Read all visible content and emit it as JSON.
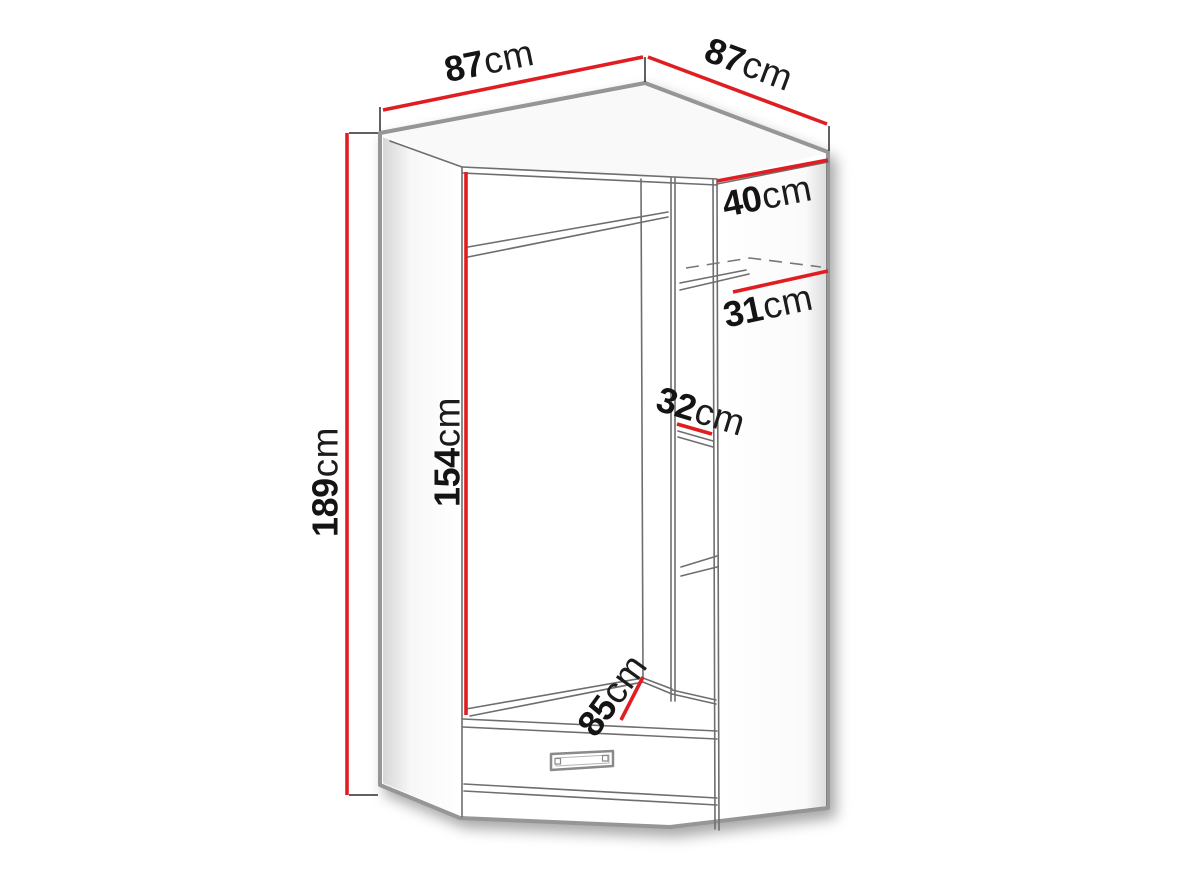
{
  "diagram": {
    "type": "furniture-dimension-diagram",
    "subject": "corner-wardrobe",
    "unit": "cm",
    "colors": {
      "dimension_line": "#e01e22",
      "outline": "#969696",
      "inner_line": "#6e6e6e",
      "label_text": "#141414",
      "background": "#ffffff"
    },
    "dimensions": [
      {
        "id": "top-width-left",
        "value": "87",
        "unit": "cm"
      },
      {
        "id": "top-width-right",
        "value": "87",
        "unit": "cm"
      },
      {
        "id": "side-depth",
        "value": "40",
        "unit": "cm"
      },
      {
        "id": "shelf-depth",
        "value": "31",
        "unit": "cm"
      },
      {
        "id": "shelf-width",
        "value": "32",
        "unit": "cm"
      },
      {
        "id": "interior-height",
        "value": "154",
        "unit": "cm"
      },
      {
        "id": "total-height",
        "value": "189",
        "unit": "cm"
      },
      {
        "id": "front-width",
        "value": "85",
        "unit": "cm"
      }
    ]
  }
}
